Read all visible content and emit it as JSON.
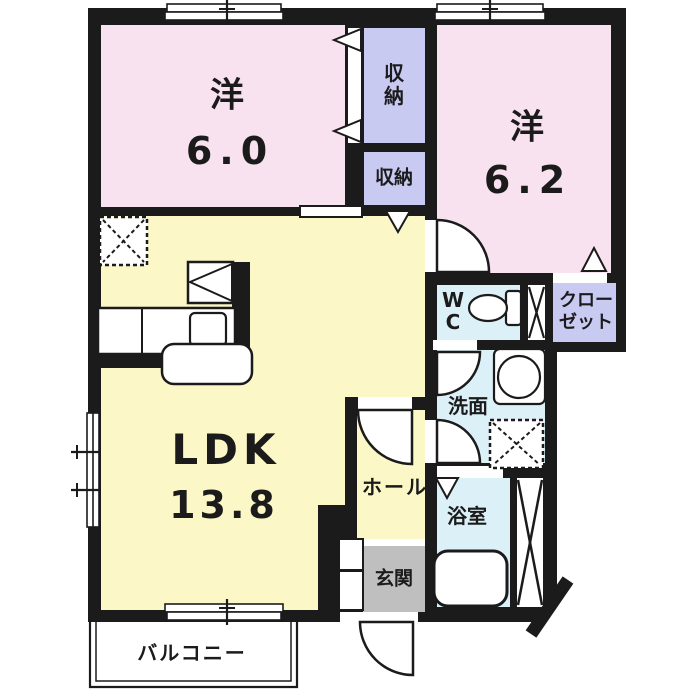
{
  "plan_title": "2LDK apartment floor plan",
  "rooms": {
    "western_6_0": {
      "name": "洋",
      "size": "6.0"
    },
    "western_6_2": {
      "name": "洋",
      "size": "6.2"
    },
    "ldk": {
      "name": "LDK",
      "size": "13.8"
    },
    "storage_upper": "収納",
    "storage_lower": "収納",
    "wc": "WC",
    "closet": "クローゼット",
    "washroom": "洗面",
    "bathroom": "浴室",
    "hall": "ホール",
    "entrance": "玄関",
    "balcony": "バルコニー"
  },
  "colors": {
    "wall": "#1b1b1b",
    "western": "#f9e2ef",
    "storage": "#c9caf2",
    "ldk": "#fbf7c7",
    "wet": "#dcf0f8",
    "entrance_gray": "#bfbfbf",
    "background": "#ffffff"
  },
  "icons": [
    "window-icon",
    "door-arc-icon",
    "folding-door-icon",
    "sliding-door-icon",
    "ps-cross-icon",
    "fridge-space-icon",
    "stove-icon",
    "kitchen-counter-icon",
    "sink-icon",
    "island-counter-icon",
    "toilet-icon",
    "washing-machine-icon",
    "washer-space-icon",
    "bathtub-icon",
    "balcony-rail-icon"
  ]
}
